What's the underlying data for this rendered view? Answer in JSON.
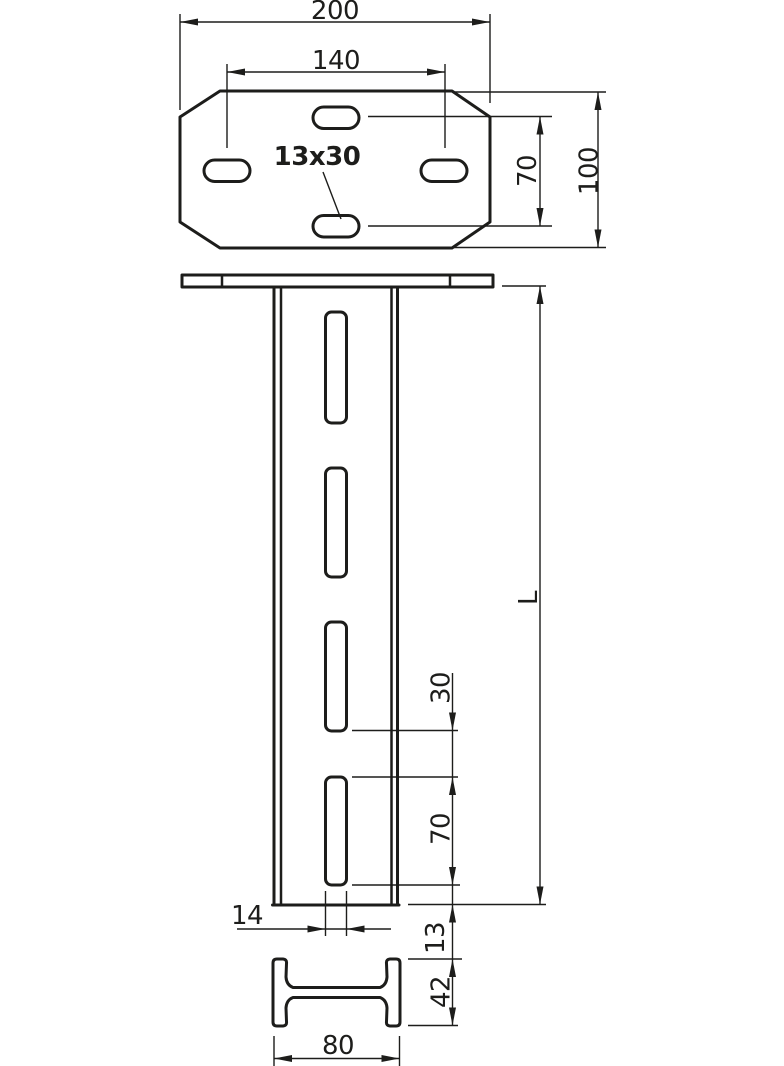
{
  "drawing": {
    "background": "#ffffff",
    "line_color": "#1d1d1b"
  },
  "top_view": {
    "plate_width": "200",
    "slot_spacing_horizontal": "140",
    "slot_size": "13x30",
    "slot_spacing_vertical": "70",
    "plate_depth": "100"
  },
  "front_view": {
    "length": "L",
    "slot_gap": "30",
    "slot_length": "70",
    "slot_width": "14",
    "slot_end_offset": "13"
  },
  "section_view": {
    "profile_height": "42",
    "profile_width": "80"
  }
}
